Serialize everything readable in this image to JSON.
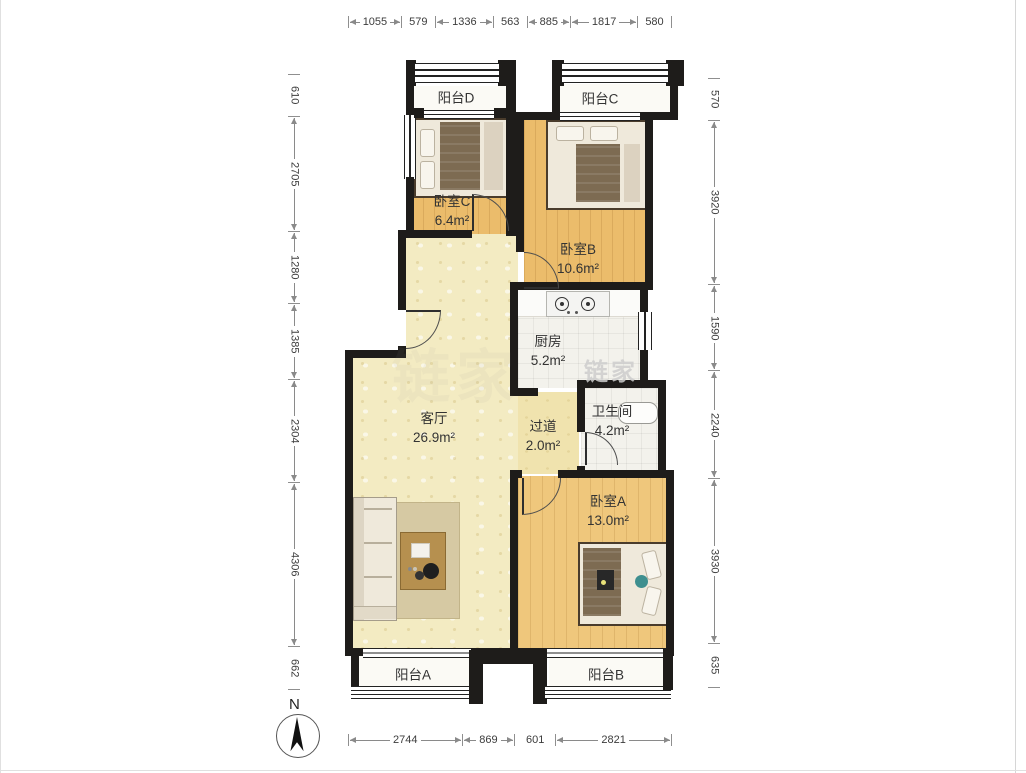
{
  "watermark": {
    "brand": "链家"
  },
  "compass": {
    "label": "N"
  },
  "dimensions": {
    "top": [
      "1055",
      "579",
      "1336",
      "563",
      "885",
      "1817",
      "580"
    ],
    "left": [
      "610",
      "2705",
      "1280",
      "1385",
      "2304",
      "4306",
      "662"
    ],
    "right": [
      "570",
      "3920",
      "1590",
      "2240",
      "3930",
      "635"
    ],
    "bottom": [
      "2744",
      "869",
      "601",
      "2821"
    ]
  },
  "rooms": {
    "balcony_d": {
      "name": "阳台D",
      "area": ""
    },
    "balcony_c": {
      "name": "阳台C",
      "area": ""
    },
    "bedroom_c": {
      "name": "卧室C",
      "area": "6.4m²"
    },
    "bedroom_b": {
      "name": "卧室B",
      "area": "10.6m²"
    },
    "kitchen": {
      "name": "厨房",
      "area": "5.2m²"
    },
    "hallway": {
      "name": "过道",
      "area": "2.0m²"
    },
    "bathroom": {
      "name": "卫生间",
      "area": "4.2m²"
    },
    "living_room": {
      "name": "客厅",
      "area": "26.9m²"
    },
    "bedroom_a": {
      "name": "卧室A",
      "area": "13.0m²"
    },
    "balcony_a": {
      "name": "阳台A",
      "area": ""
    },
    "balcony_b": {
      "name": "阳台B",
      "area": ""
    }
  },
  "colors": {
    "wall": "#1E1C1A",
    "bedroom_floor": "#EBBC6B",
    "living_floor": "#F3EBC2",
    "tile_floor": "#F3F2EC",
    "balcony_floor": "#FBFAF5",
    "dimension_text": "#3c3c3c",
    "label_text": "#333333"
  }
}
